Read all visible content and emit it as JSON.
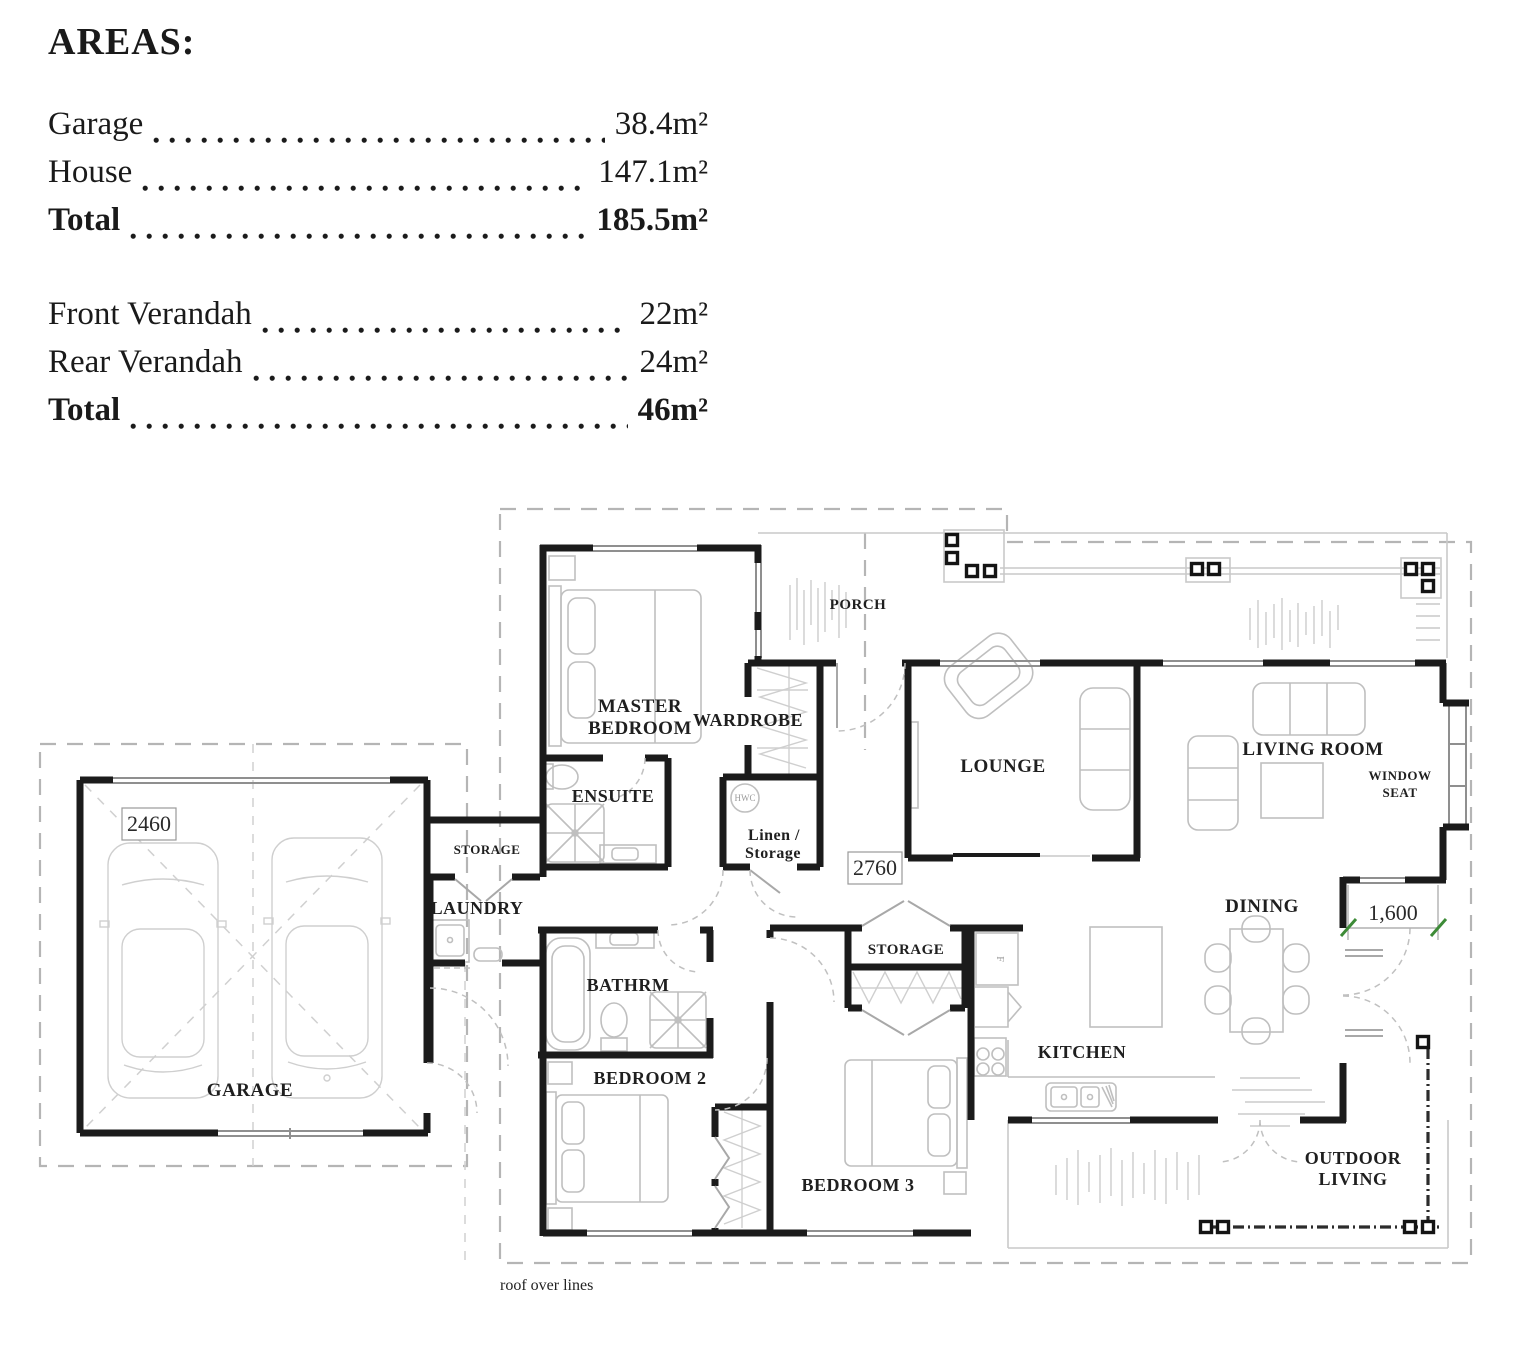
{
  "areas": {
    "title": "AREAS:",
    "building": [
      {
        "label": "Garage",
        "value": "38.4m²"
      },
      {
        "label": "House",
        "value": "147.1m²"
      },
      {
        "label": "Total",
        "value": "185.5m²"
      }
    ],
    "verandahs": [
      {
        "label": "Front Verandah",
        "value": "22m²"
      },
      {
        "label": "Rear Verandah",
        "value": "24m²"
      },
      {
        "label": "Total",
        "value": "46m²"
      }
    ]
  },
  "plan": {
    "rooms": {
      "master1": "MASTER",
      "master2": "BEDROOM",
      "wardrobe": "WARDROBE",
      "porch": "PORCH",
      "lounge": "LOUNGE",
      "living": "LIVING ROOM",
      "window_seat1": "WINDOW",
      "window_seat2": "SEAT",
      "ensuite": "ENSUITE",
      "linen1": "Linen /",
      "linen2": "Storage",
      "storage_garage": "STORAGE",
      "laundry": "LAUNDRY",
      "bathroom": "BATHRM",
      "bedroom2": "BEDROOM 2",
      "storage_hall": "STORAGE",
      "bedroom3": "BEDROOM 3",
      "kitchen": "KITCHEN",
      "dining": "DINING",
      "outdoor1": "OUTDOOR",
      "outdoor2": "LIVING",
      "garage": "GARAGE"
    },
    "fixtures": {
      "hwc": "HWC",
      "fridge": "F"
    },
    "dimensions": {
      "garage_bay": "2460",
      "hall": "2760",
      "deck": "1,600"
    },
    "notes": {
      "roof": "roof over lines"
    },
    "colors": {
      "wall": "#1b1b1b",
      "roof_dash": "#b5b5b5",
      "dim_tick": "#3d8b37"
    }
  }
}
